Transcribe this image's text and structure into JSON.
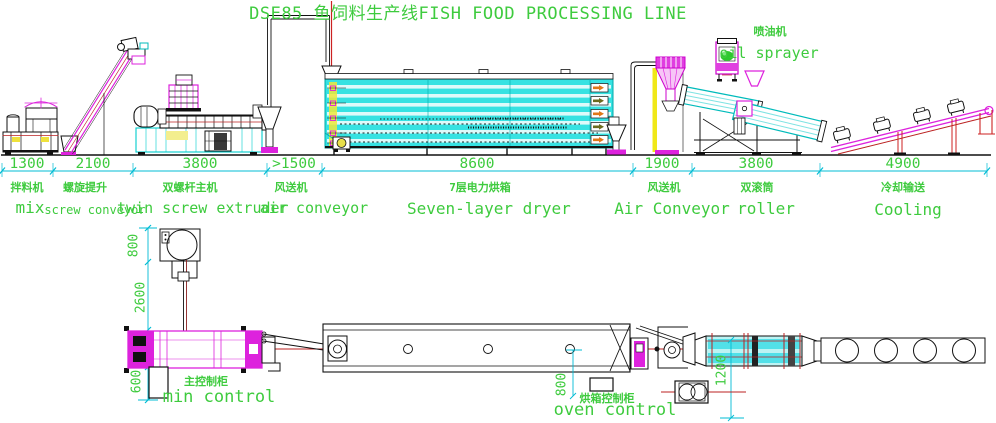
{
  "title": "DSE85 鱼饲料生产线FISH FOOD PROCESSING LINE",
  "colors": {
    "annotation_green": "#3ecb3e",
    "dimension_cyan": "#00bcd4",
    "machine_cyan": "#00cccc",
    "magenta": "#dd22dd",
    "red": "#cc2222",
    "yellow": "#f0e818",
    "dryer_fill": "#36e2e2",
    "orange_arrow": "#e07818"
  },
  "stations": [
    {
      "dimension_mm": "1300",
      "label_cn": "拌料机",
      "label_en": "mix"
    },
    {
      "dimension_mm": "2100",
      "label_cn": "螺旋提升",
      "label_en": "screw conveyor"
    },
    {
      "dimension_mm": "3800",
      "label_cn": "双螺杆主机",
      "label_en": "twin screw extruder"
    },
    {
      "dimension_mm": ">1500",
      "label_cn": "风送机",
      "label_en": "air conveyor"
    },
    {
      "dimension_mm": "8600",
      "label_cn": "7层电力烘箱",
      "label_en": "Seven-layer dryer"
    },
    {
      "dimension_mm": "1900",
      "label_cn": "风送机",
      "label_en": "Air Conveyor"
    },
    {
      "dimension_mm": "3800",
      "label_cn": "双滚筒",
      "label_en": "roller"
    },
    {
      "dimension_mm": "4900",
      "label_cn": "冷却输送",
      "label_en": "Cooling"
    }
  ],
  "callouts": {
    "oil_sprayer": {
      "cn": "喷油机",
      "en": "oil sprayer"
    },
    "main_control": {
      "cn": "主控制柜",
      "en": "min control"
    },
    "oven_control": {
      "cn": "烘箱控制柜",
      "en": "oven control"
    }
  },
  "plan_dimensions": {
    "feeder_width": "800",
    "feeder_to_extruder": "2600",
    "cabinet_offset": "600",
    "oven_cabinet_offset": "800",
    "roller_offset": "1200"
  }
}
